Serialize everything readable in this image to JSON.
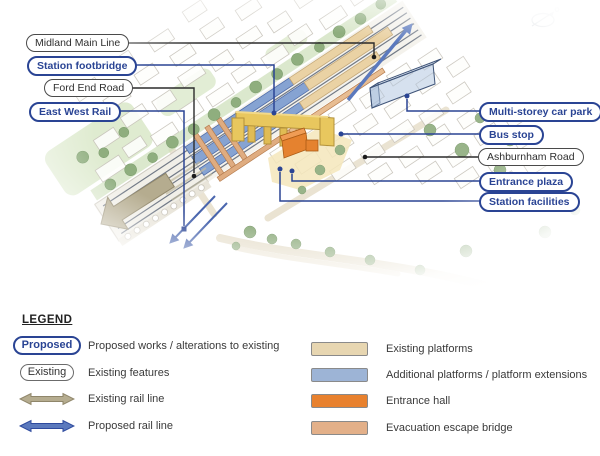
{
  "callouts": [
    {
      "text": "Midland Main Line",
      "variant": "existing"
    },
    {
      "text": "Station footbridge",
      "variant": "proposed"
    },
    {
      "text": "Ford End Road",
      "variant": "existing"
    },
    {
      "text": "East West Rail",
      "variant": "proposed"
    },
    {
      "text": "Multi-storey car park",
      "variant": "proposed"
    },
    {
      "text": "Bus stop",
      "variant": "proposed"
    },
    {
      "text": "Ashburnham Road",
      "variant": "existing"
    },
    {
      "text": "Entrance plaza",
      "variant": "proposed"
    },
    {
      "text": "Station facilities",
      "variant": "proposed"
    }
  ],
  "legend": {
    "title": "LEGEND",
    "items_left": [
      {
        "type": "pill-proposed",
        "swatch_label": "Proposed",
        "label": "Proposed works / alterations to existing"
      },
      {
        "type": "pill-existing",
        "swatch_label": "Existing",
        "label": "Existing features"
      },
      {
        "type": "arrow-existing",
        "label": "Existing rail line"
      },
      {
        "type": "arrow-proposed",
        "label": "Proposed rail line"
      }
    ],
    "items_right": [
      {
        "type": "swatch",
        "color": "#e7d6b1",
        "label": "Existing platforms"
      },
      {
        "type": "swatch",
        "color": "#9db4d6",
        "label": "Additional platforms / platform extensions"
      },
      {
        "type": "swatch",
        "color": "#e8812e",
        "label": "Entrance hall"
      },
      {
        "type": "swatch",
        "color": "#e3b089",
        "label": "Evacuation escape bridge"
      }
    ]
  },
  "colors": {
    "proposed_blue": "#2a4494",
    "existing_dark": "#3a3a3a",
    "existing_rail_tan": "#b5ac8f",
    "proposed_rail_blue": "#5b79bd",
    "footbridge_yellow": "#e8c75e",
    "entrance_hall_orange": "#e5822f",
    "escape_bridge_salmon": "#dfac80",
    "platform_existing": "#ead2a4",
    "platform_additional": "#86a3d2"
  }
}
